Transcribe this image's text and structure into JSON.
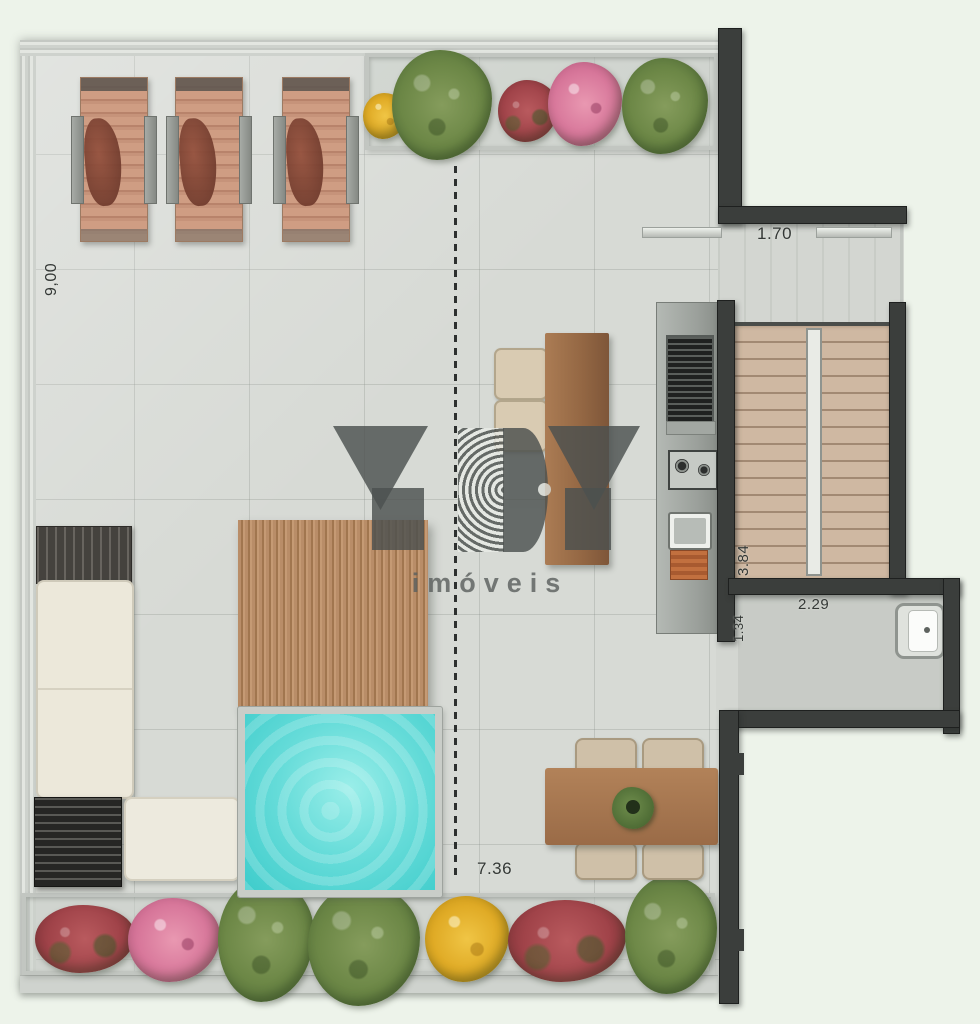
{
  "watermark": {
    "brand": "YBY",
    "subtitle": "imóveis"
  },
  "dimensions": {
    "left_side": "9,00",
    "upper_opening": "1.70",
    "stairs_depth": "3.84",
    "bathroom_depth": "1.34",
    "bathroom_width": "2.29",
    "bottom_width": "7.36"
  },
  "palette": {
    "background": "#edf3ea",
    "floor_tile": "#d7dad5",
    "wall": "#3b3e3c",
    "pool_water": "#5ad6d3",
    "pergola_wood": "#ad8160",
    "stair_wood": "#cfb8a2",
    "lounge_wood": "#c6937a",
    "sofa_cream": "#ece8da",
    "foliage_green": "#6c8746",
    "flower_pink": "#d8789b",
    "flower_yellow": "#e0ab26",
    "flower_red": "#a04349"
  }
}
